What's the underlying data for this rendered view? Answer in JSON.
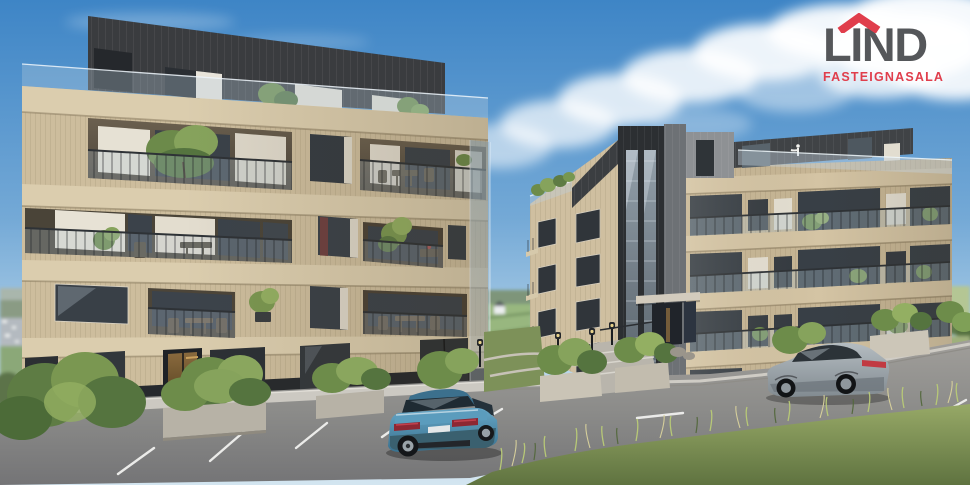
{
  "canvas": {
    "width": 970,
    "height": 485
  },
  "logo": {
    "brand": "LIND",
    "tagline": "FASTEIGNASALA",
    "colors": {
      "brand_text": "#55575A",
      "accent_red": "#E03E4C"
    }
  },
  "scene": {
    "description": "Architectural 3D rendering of two modern apartment buildings with sand-beige vertical cladding, dark zinc penthouse levels, glass-and-steel balconies with plants, a parking lot with two parked cars, landscaped stone planters, path lamps and a blue sky with a white cloud bank",
    "sky": {
      "top_color": "#3E85C6",
      "horizon_color": "#D3E5F0",
      "cloud_color": "#FFFFFF"
    },
    "buildings": {
      "left": {
        "visible_floors": 5,
        "facade_color": "#CDBD9D",
        "penthouse_color": "#3A3C3F",
        "railing_color": "#2E3236",
        "ground_floor": "dark plinth with warm lit entrance"
      },
      "right": {
        "visible_floors": 6,
        "facade_color": "#C7B695",
        "roof_band_color": "#404346",
        "stair_tower_color": "#2C2F32",
        "stair_glazing": "full-height reflective glass strips"
      }
    },
    "vehicles": [
      {
        "type": "sedan",
        "color_name": "teal-blue",
        "color": "#4E92B5",
        "position": "parked nose-in at center parking row"
      },
      {
        "type": "coupe",
        "color_name": "silver-gray",
        "color": "#A9B2B8",
        "position": "on the road in front of right building"
      }
    ],
    "ground": {
      "asphalt_color": "#8E8D8B",
      "marking_color": "#EBEBE9",
      "sidewalk_color": "#CCC9C2",
      "grass_color": "#7D8F52",
      "shrub_color": "#6D8C4A"
    }
  }
}
